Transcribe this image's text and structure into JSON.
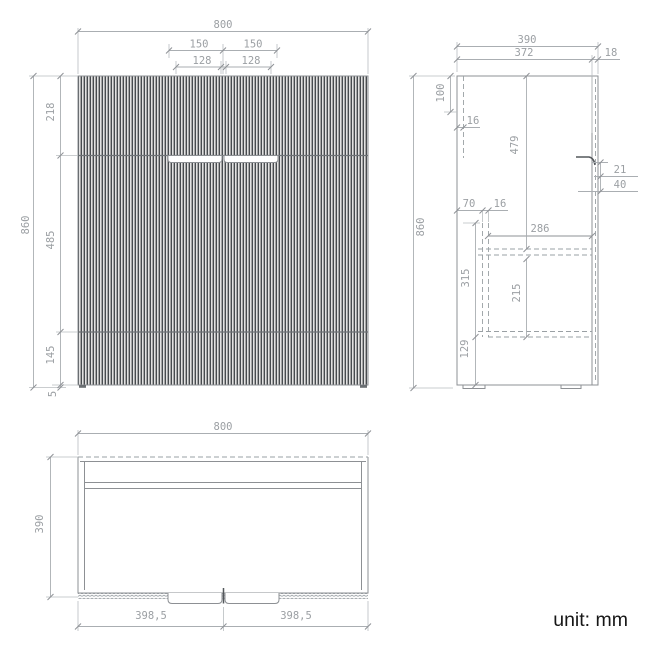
{
  "unit_note": "unit: mm",
  "front_view": {
    "overall_width": "800",
    "groove_span_left": "150",
    "groove_span_right": "150",
    "handle_recess_left": "128",
    "handle_recess_right": "128",
    "overall_height": "860",
    "top_to_groove": "218",
    "groove_to_groove": "485",
    "groove_to_bottom": "145",
    "foot_height": "5"
  },
  "side_view": {
    "overall_depth": "390",
    "body_depth": "372",
    "back_gap": "18",
    "overall_height": "860",
    "top_recess_height": "100",
    "panel_thickness": "16",
    "upper_section_height": "479",
    "handle_lip": "21",
    "handle_clearance": "40",
    "rail_setback": "70",
    "rail_thickness": "16",
    "shelf_depth": "286",
    "shelf_section_height": "315",
    "lower_clearance": "215",
    "base_height": "129"
  },
  "top_view": {
    "overall_width": "800",
    "overall_depth": "390",
    "door_width_left": "398,5",
    "door_width_right": "398,5"
  },
  "colors": {
    "outline": "#8d9094",
    "dimension": "#9b9fa3",
    "hidden": "#9aa0a4",
    "flute_dark": "#474b4f",
    "flute_light": "#e2e2e2",
    "flute_mid": "#a6a6a6",
    "text_black": "#161616",
    "background": "#ffffff"
  }
}
